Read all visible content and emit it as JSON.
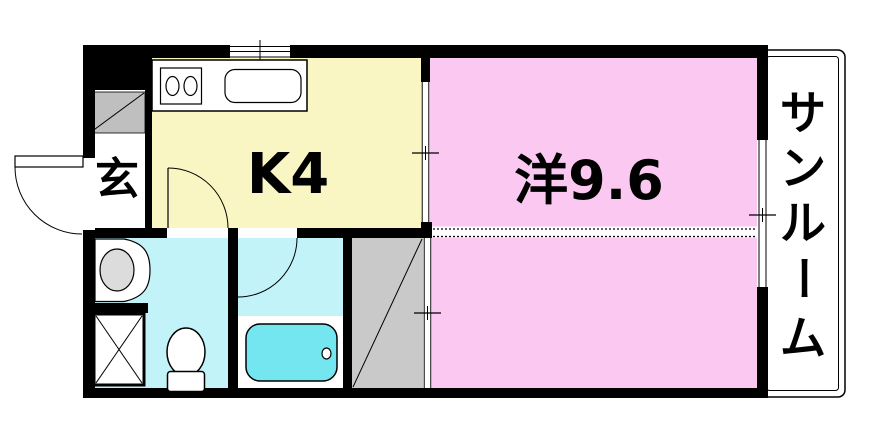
{
  "plan": {
    "type": "apartment-floor-plan",
    "rooms": {
      "genkan": {
        "label": "玄"
      },
      "kitchen": {
        "label": "K4"
      },
      "living": {
        "label": "洋9.6"
      },
      "sunroom": {
        "label": "サンルーム",
        "label_chars": [
          "サ",
          "ン",
          "ル",
          "ー",
          "ム"
        ]
      }
    }
  },
  "colors": {
    "wall": "#000000",
    "kitchen": "#FAF6C3",
    "room": "#FAC8F1",
    "wet": "#C2F3F8",
    "tub": "#74E6F0",
    "closet": "#C9C9C9",
    "shaft": "#BFBFBF",
    "basin": "#DCDCDC",
    "white": "#FFFFFF"
  }
}
